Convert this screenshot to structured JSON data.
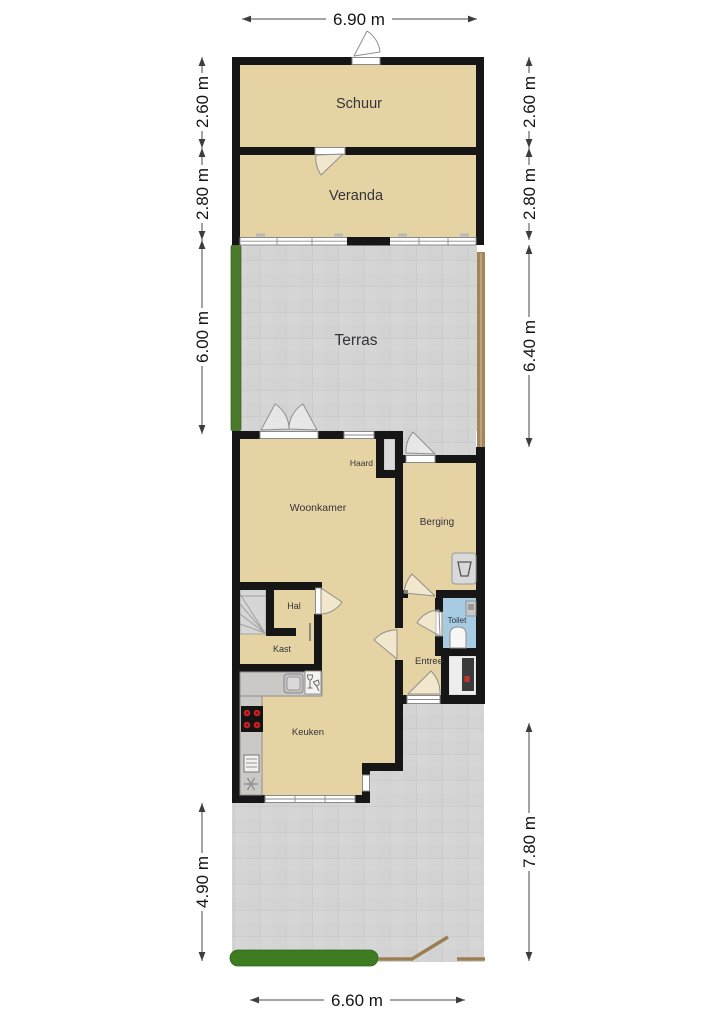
{
  "plan": {
    "title": "Floor plan (begane grond met tuin)",
    "rooms": {
      "schuur": "Schuur",
      "veranda": "Veranda",
      "terras": "Terras",
      "woonkamer": "Woonkamer",
      "haard": "Haard",
      "berging": "Berging",
      "hal": "Hal",
      "kast": "Kast",
      "toilet": "Toilet",
      "entree": "Entree",
      "keuken": "Keuken"
    },
    "dimensions": {
      "top": "6.90 m",
      "bottom": "6.60 m",
      "left": [
        "2.60 m",
        "2.80 m",
        "6.00 m",
        "4.90 m"
      ],
      "right": [
        "2.60 m",
        "2.80 m",
        "6.40 m",
        "7.80 m"
      ]
    },
    "colors": {
      "room_fill": "#e6d3a3",
      "wall": "#161616",
      "paving": "#d4d4d4",
      "paving_grid": "#c8c8c8",
      "hedge_green": "#4b7a2d",
      "lawn_green": "#3e7c22",
      "fence_brown": "#a2855b",
      "toilet_blue": "#a6cbe2",
      "counter_gray": "#cbc9c6",
      "burner_red": "#c52222"
    }
  }
}
